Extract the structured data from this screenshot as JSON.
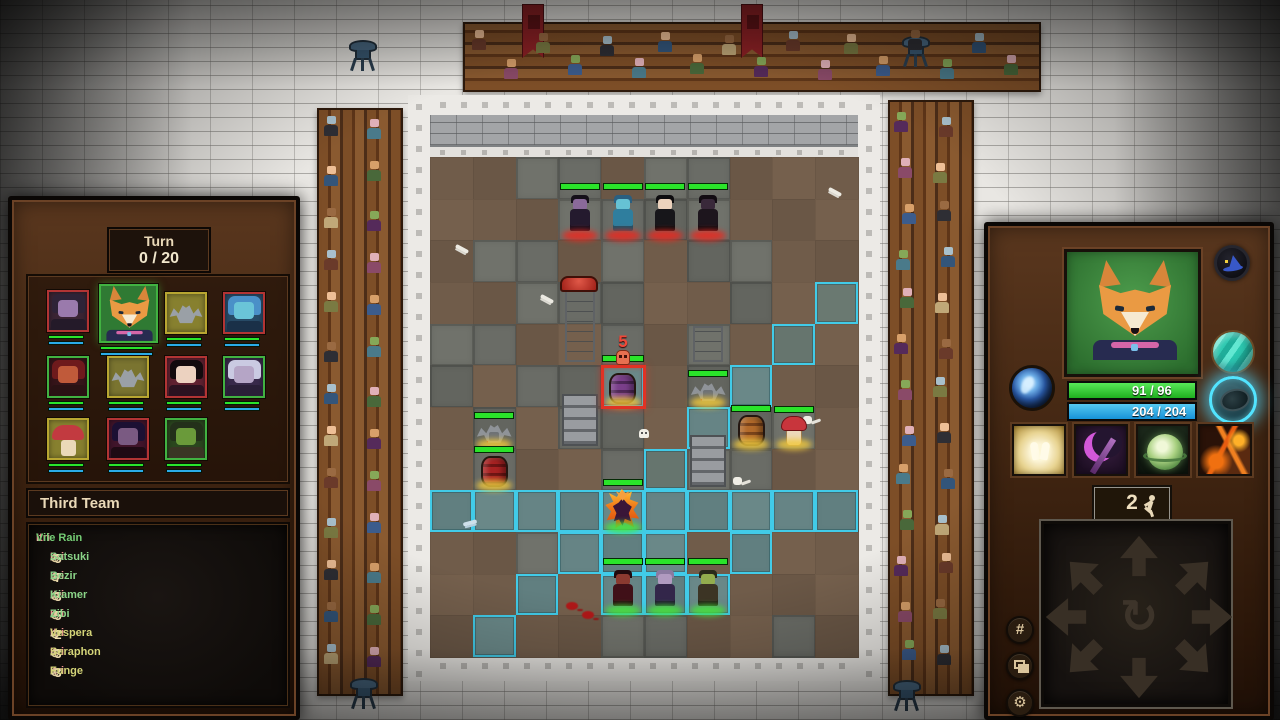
{
  "icons": {
    "grid": "#",
    "gear": "⚙",
    "rotate": "↻",
    "log_target": "⊕"
  },
  "colors": {
    "hp_green": "#2fd02f",
    "mp_blue": "#2aabe8",
    "highlight_cyan": "#41cbe8",
    "target_red": "#e03224",
    "damage_red": "#f04838"
  },
  "left_panel": {
    "turn_label": "Turn",
    "turn_value": "0 / 20",
    "team_title": "Third Team",
    "log_header": {
      "actor": "Itri",
      "sep": " : ",
      "skill": "Vile Rain"
    },
    "log_entries": [
      {
        "actor": "Itri",
        "amount": "-5",
        "target": "Satsuki",
        "tone": "green"
      },
      {
        "actor": "Itri",
        "amount": "-7",
        "target": "Bezir",
        "tone": "green"
      },
      {
        "actor": "Itri",
        "amount": "-3",
        "target": "Kiamer",
        "tone": "green"
      },
      {
        "actor": "Itri",
        "amount": "-5",
        "target": "Zibi",
        "tone": "green"
      },
      {
        "actor": "Itri",
        "amount": "-2",
        "target": "Vespera",
        "tone": "yellow"
      },
      {
        "actor": "Itri",
        "amount": "-3",
        "target": "Seraphon",
        "tone": "yellow"
      },
      {
        "actor": "Itri",
        "amount": "-3",
        "target": "Funge",
        "tone": "yellow"
      }
    ],
    "portraits": [
      {
        "name": "portrait-shade",
        "border": "red",
        "kind": "person",
        "bg": "#3a2433",
        "hair": "#2e2337",
        "skin": "#9a7aac",
        "cloth": "#241a29"
      },
      {
        "name": "portrait-itri-fox",
        "border": "green",
        "kind": "fox",
        "bg": "#2f7a33",
        "selected": true
      },
      {
        "name": "portrait-gargoyle-a",
        "border": "yellow",
        "kind": "bat",
        "bg": "#87802f"
      },
      {
        "name": "portrait-siren",
        "border": "red",
        "kind": "person",
        "bg": "#274a66",
        "hair": "#4a90c8",
        "skin": "#6ac4d8",
        "cloth": "#1a3048"
      },
      {
        "name": "portrait-demoness",
        "border": "green",
        "kind": "person",
        "bg": "#351419",
        "hair": "#6e1a1c",
        "skin": "#c05a3a",
        "cloth": "#2a1214"
      },
      {
        "name": "portrait-gargoyle-b",
        "border": "yellow",
        "kind": "bat",
        "bg": "#7a7430"
      },
      {
        "name": "portrait-raven-lady",
        "border": "red",
        "kind": "person",
        "bg": "#5f2130",
        "hair": "#120a0d",
        "skin": "#ecd2c0",
        "cloth": "#2b1220"
      },
      {
        "name": "portrait-pale-elf",
        "border": "green",
        "kind": "person",
        "bg": "#38294a",
        "hair": "#cacae2",
        "skin": "#b5a5c6",
        "cloth": "#2a1f38"
      },
      {
        "name": "portrait-mushroom",
        "border": "yellow",
        "kind": "mushroom",
        "bg": "#87802f",
        "cap": "#c23a40",
        "stem": "#ead9b8"
      },
      {
        "name": "portrait-vampire",
        "border": "red",
        "kind": "person",
        "bg": "#40142a",
        "hair": "#1c1033",
        "skin": "#7a5a82",
        "cloth": "#1f0a14"
      },
      {
        "name": "portrait-orc",
        "border": "green",
        "kind": "person",
        "bg": "#2a461e",
        "hair": "#23301a",
        "skin": "#6a9a3a",
        "cloth": "#3a3524"
      }
    ]
  },
  "right_panel": {
    "hp": "91 / 96",
    "mp": "204 / 204",
    "moves": "2",
    "abilities": [
      "heal-ability",
      "axe-ability",
      "sphere-ability",
      "lava-ability"
    ],
    "orbs": [
      "spirit-orb",
      "gem-orb",
      "focus-orb"
    ]
  },
  "battlefield": {
    "target_damage": "5",
    "tile_map": [
      "bbggbggbbb",
      "bbbggggbbb",
      "bggbgbggbb",
      "bbgggbbgbb",
      "ggbbgbgbbb",
      "gbgggbggbb",
      "bgbggbgggb",
      "bgbbgbggbb",
      "gggggggggg",
      "bbggggbgbb",
      "bbgbgggbbb",
      "bgbbggbbgb"
    ],
    "highlight_tiles": [
      [
        9,
        3
      ],
      [
        8,
        4
      ],
      [
        7,
        5
      ],
      [
        6,
        6
      ],
      [
        5,
        7
      ],
      [
        0,
        8
      ],
      [
        1,
        8
      ],
      [
        2,
        8
      ],
      [
        3,
        8
      ],
      [
        4,
        8
      ],
      [
        5,
        8
      ],
      [
        6,
        8
      ],
      [
        7,
        8
      ],
      [
        8,
        8
      ],
      [
        9,
        8
      ],
      [
        3,
        9
      ],
      [
        4,
        9
      ],
      [
        5,
        9
      ],
      [
        7,
        9
      ],
      [
        2,
        10
      ],
      [
        4,
        10
      ],
      [
        5,
        10
      ],
      [
        6,
        10
      ],
      [
        1,
        11
      ],
      [
        4,
        5
      ]
    ],
    "target_tile": [
      4,
      5
    ],
    "units": [
      {
        "name": "shadow-beast",
        "type": "humanoid",
        "col": 3,
        "row": 1,
        "glow": "red",
        "hp": true,
        "body": "#241a2e",
        "head": "#8a6a9a",
        "hair": "#151019"
      },
      {
        "name": "tide-warrior",
        "type": "humanoid",
        "col": 4,
        "row": 1,
        "glow": "red",
        "hp": true,
        "body": "#2f7e9e",
        "head": "#66c2d4",
        "hair": "#2a5f80"
      },
      {
        "name": "dark-lady",
        "type": "humanoid",
        "col": 5,
        "row": 1,
        "glow": "red",
        "hp": true,
        "body": "#17161a",
        "head": "#ecd2bc",
        "hair": "#0d0c0e"
      },
      {
        "name": "panther-stalker",
        "type": "humanoid",
        "col": 6,
        "row": 1,
        "glow": "red",
        "hp": true,
        "body": "#1d151d",
        "head": "#39293a",
        "hair": "#120c12"
      },
      {
        "name": "red-capped-pillar",
        "type": "pillar",
        "col": 3,
        "row": 4
      },
      {
        "name": "small-pillar",
        "type": "pillar2",
        "col": 6,
        "row": 4
      },
      {
        "name": "stone-stairs-left",
        "type": "stairs",
        "col": 3,
        "row": 6
      },
      {
        "name": "gargoyle-upper",
        "type": "gargoyle",
        "col": 6,
        "row": 5,
        "glow": "yellow",
        "hp": true
      },
      {
        "name": "target-barrel",
        "type": "barrel",
        "col": 4,
        "row": 5,
        "glow": "yellow",
        "hp": false,
        "wood": "#7a3f8a",
        "band": "#4e2758"
      },
      {
        "name": "gargoyle-lower",
        "type": "gargoyle",
        "col": 1,
        "row": 6,
        "glow": "yellow",
        "hp": true
      },
      {
        "name": "wooden-barrel",
        "type": "barrel",
        "col": 7,
        "row": 6,
        "glow": "yellow",
        "hp": true,
        "wood": "#b26a2a",
        "band": "#79421a"
      },
      {
        "name": "mushroom-brawler",
        "type": "mushroom",
        "col": 8,
        "row": 6,
        "glow": "yellow",
        "hp": true
      },
      {
        "name": "red-barrel",
        "type": "barrel",
        "col": 1,
        "row": 7,
        "glow": "yellow",
        "hp": true,
        "wood": "#a82222",
        "band": "#6e1414"
      },
      {
        "name": "stone-stairs-right",
        "type": "stairs",
        "col": 6,
        "row": 7
      },
      {
        "name": "itri-burning-fox",
        "type": "flame",
        "col": 4,
        "row": 8,
        "glow": "green",
        "hp": true
      },
      {
        "name": "demon-ally",
        "type": "humanoid",
        "col": 4,
        "row": 10,
        "glow": "green",
        "hp": true,
        "body": "#401018",
        "head": "#8a3a30",
        "hair": "#200a0e"
      },
      {
        "name": "mystic-ally",
        "type": "humanoid",
        "col": 5,
        "row": 10,
        "glow": "green",
        "hp": true,
        "body": "#33264a",
        "head": "#b09ac0",
        "hair": "#8a7aa0"
      },
      {
        "name": "orc-ally",
        "type": "humanoid",
        "col": 6,
        "row": 10,
        "glow": "green",
        "hp": true,
        "body": "#3c3424",
        "head": "#93ad4e",
        "hair": "#2a2a1a"
      }
    ],
    "decorations": [
      {
        "type": "bone",
        "x": 455,
        "y": 247
      },
      {
        "type": "bone",
        "x": 540,
        "y": 297
      },
      {
        "type": "bone",
        "x": 575,
        "y": 432
      },
      {
        "type": "skullbone",
        "x": 803,
        "y": 416
      },
      {
        "type": "bone",
        "x": 828,
        "y": 190
      },
      {
        "type": "skullbone",
        "x": 733,
        "y": 477
      },
      {
        "type": "bone-blue",
        "x": 463,
        "y": 521
      },
      {
        "type": "skull",
        "x": 639,
        "y": 429
      },
      {
        "type": "blood",
        "x": 566,
        "y": 602
      },
      {
        "type": "blood",
        "x": 582,
        "y": 611
      }
    ]
  },
  "environment": {
    "statues": [
      478,
      776
    ],
    "banners": [
      522,
      741
    ],
    "braziers": [
      [
        349,
        36
      ],
      [
        902,
        32
      ],
      [
        350,
        674
      ],
      [
        893,
        676
      ]
    ],
    "crowd": {
      "top_count": 18,
      "side_count": 26,
      "palette_skin": [
        "#eebf96",
        "#d8a06a",
        "#9a6a42",
        "#86a858",
        "#a8c0cc",
        "#e0b0b8"
      ],
      "palette_body": [
        "#3c5c8c",
        "#6a3a2a",
        "#49683a",
        "#2e2e34",
        "#8a4a68",
        "#c0a878",
        "#4a7a8a",
        "#7a7a42",
        "#552a5a",
        "#33557a"
      ]
    }
  }
}
